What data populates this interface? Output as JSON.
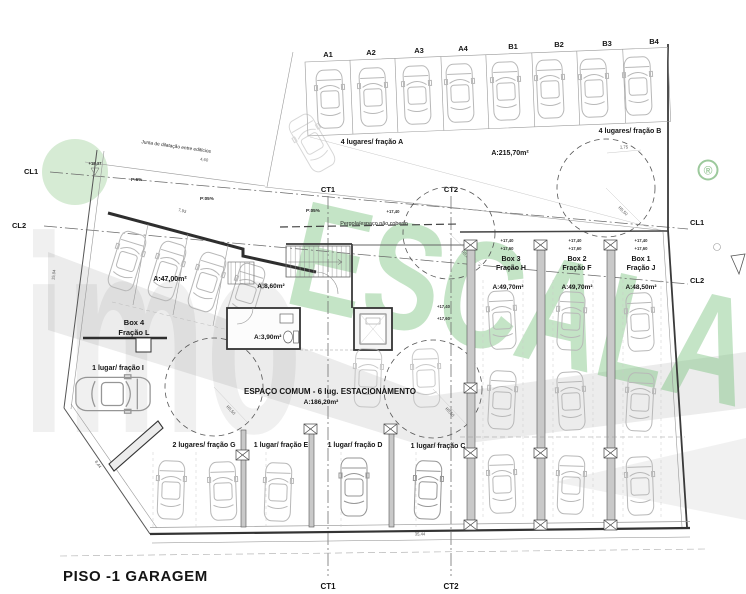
{
  "title": "PISO -1 GARAGEM",
  "stalls_top": [
    "A1",
    "A2",
    "A3",
    "A4",
    "B1",
    "B2",
    "B3",
    "B4"
  ],
  "groups": {
    "fracao_a": "4 lugares/ fração A",
    "total_area": "A:215,70m²",
    "fracao_b": "4 lugares/ fração B",
    "fracao_g": "2 lugares/ fração G",
    "fracao_e": "1 lugar/ fração E",
    "fracao_d": "1 lugar/ fração D",
    "fracao_c": "1 lugar/ fração C",
    "fracao_i": "1 lugar/ fração I"
  },
  "boxes": {
    "box4": {
      "name": "Box 4",
      "fraction": "Fração L",
      "area": "A:47,00m²"
    },
    "box3": {
      "name": "Box 3",
      "fraction": "Fração H",
      "area": "A:49,70m²"
    },
    "box2": {
      "name": "Box 2",
      "fraction": "Fração F",
      "area": "A:49,70m²"
    },
    "box1": {
      "name": "Box 1",
      "fraction": "Fração J",
      "area": "A:48,50m²"
    }
  },
  "rooms": {
    "hall_area": "A:8,60m²",
    "wc_area": "A:3,90m²"
  },
  "common": {
    "line1": "ESPAÇO COMUM - 6 lug. ESTACIONAMENTO",
    "line2": "A:186,20m²"
  },
  "axes": {
    "cl1": "CL1",
    "cl2": "CL2",
    "ct1": "CT1",
    "ct2": "CT2"
  },
  "notes": {
    "junta": "Junta de dilatação entre edifícios",
    "pergola": "Pergola/espaço não coberto"
  },
  "levels": {
    "l1": "+18,37",
    "l2": "+17,40",
    "l3": "+17,60"
  },
  "slopes": {
    "s1": "P:6%",
    "s2": "P:05%"
  },
  "dims": {
    "d1": "7,93",
    "d2": "15,04",
    "d3": "8,44",
    "d4": "35,44",
    "d5": "1,75",
    "d6": "4,60",
    "r1": "R5,50"
  },
  "watermark": {
    "word1": "imo",
    "word2": "ESCALA",
    "reg": "®"
  }
}
